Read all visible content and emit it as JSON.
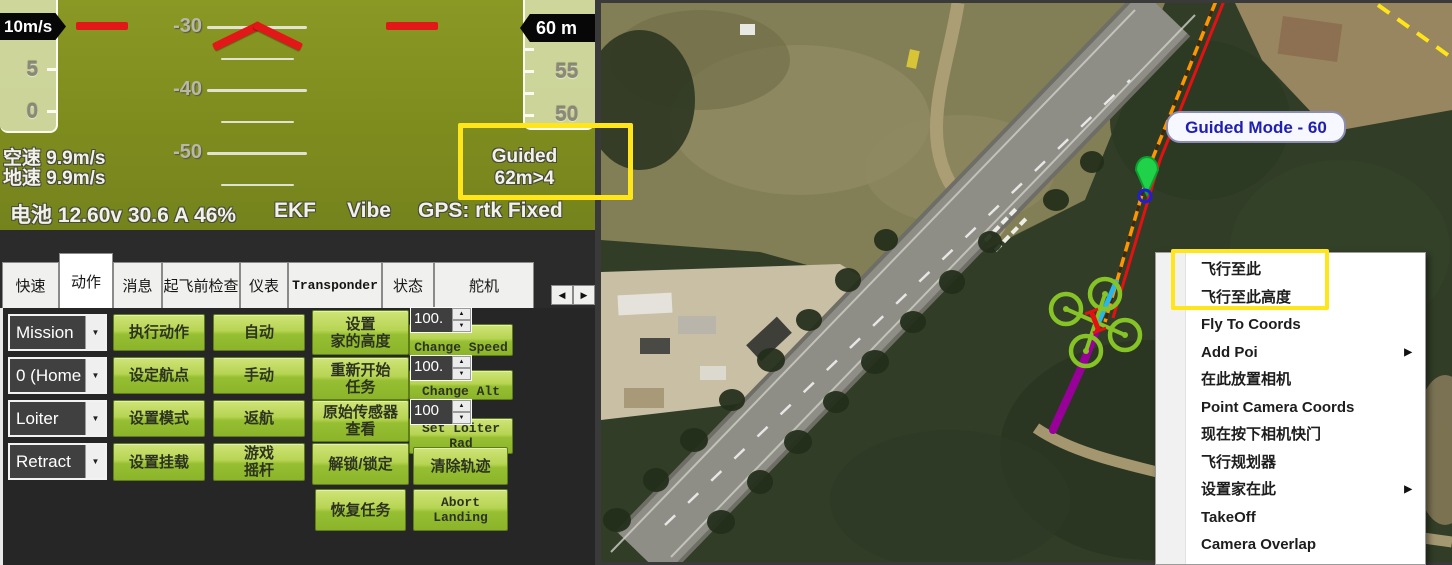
{
  "hud": {
    "airspeed_box": "10m/s",
    "speed_ticks": [
      "5",
      "0"
    ],
    "alt_box": "60 m",
    "alt_ticks": [
      "55",
      "50"
    ],
    "pitch_labels": [
      "-30",
      "-40",
      "-50"
    ],
    "airspeed": "空速 9.9m/s",
    "groundspeed": "地速 9.9m/s",
    "mode": "Guided",
    "target": "62m>4",
    "battery": "电池 12.60v 30.6 A 46%",
    "ekf": "EKF",
    "vibe": "Vibe",
    "gps": "GPS: rtk Fixed"
  },
  "tabs": {
    "items": [
      {
        "label": "快速"
      },
      {
        "label": "动作"
      },
      {
        "label": "消息"
      },
      {
        "label": "起飞前检查"
      },
      {
        "label": "仪表"
      },
      {
        "label": "Transponder"
      },
      {
        "label": "状态"
      },
      {
        "label": "舵机"
      }
    ],
    "active": "动作",
    "scroll_left": "◀",
    "scroll_right": "▶"
  },
  "actions": {
    "dropdowns": [
      {
        "value": "Mission"
      },
      {
        "value": "0 (Home"
      },
      {
        "value": "Loiter"
      },
      {
        "value": "Retract"
      }
    ],
    "buttons": {
      "execute": "执行动作",
      "set_waypoint": "设定航点",
      "set_mode": "设置模式",
      "set_mount": "设置挂载",
      "auto": "自动",
      "manual": "手动",
      "rtl": "返航",
      "joystick": "游戏\n摇杆",
      "set_home_alt": "设置\n家的高度",
      "restart_mission": "重新开始\n任务",
      "raw_sensor_view": "原始传感器\n查看",
      "arm_disarm": "解锁/锁定",
      "resume_mission": "恢复任务",
      "change_speed": "Change Speed",
      "change_alt": "Change Alt",
      "set_loiter": "Set Loiter\nRad",
      "clear_track": "清除轨迹",
      "abort_landing": "Abort\nLanding"
    },
    "steppers": [
      "100.",
      "100.",
      "100"
    ]
  },
  "map": {
    "tooltip": "Guided Mode - 60"
  },
  "context_menu": {
    "items": [
      {
        "label": "飞行至此"
      },
      {
        "label": "飞行至此高度"
      },
      {
        "label": "Fly To Coords"
      },
      {
        "label": "Add Poi",
        "submenu": "▶"
      },
      {
        "label": "在此放置相机"
      },
      {
        "label": "Point Camera Coords"
      },
      {
        "label": "现在按下相机快门"
      },
      {
        "label": "飞行规划器"
      },
      {
        "label": "设置家在此",
        "submenu": "▶"
      },
      {
        "label": "TakeOff"
      },
      {
        "label": "Camera Overlap"
      }
    ]
  },
  "colors": {
    "highlight_yellow": "#ffe61a",
    "hud_green": "#7e8c1e",
    "button_green": "#97bf33",
    "trail_purple": "#990099",
    "path_orange": "#ff9500",
    "path_red": "#e31111",
    "heading_cyan": "#29b6e8",
    "drone_green": "#86c327",
    "mode_text_blue": "#2020b0"
  }
}
